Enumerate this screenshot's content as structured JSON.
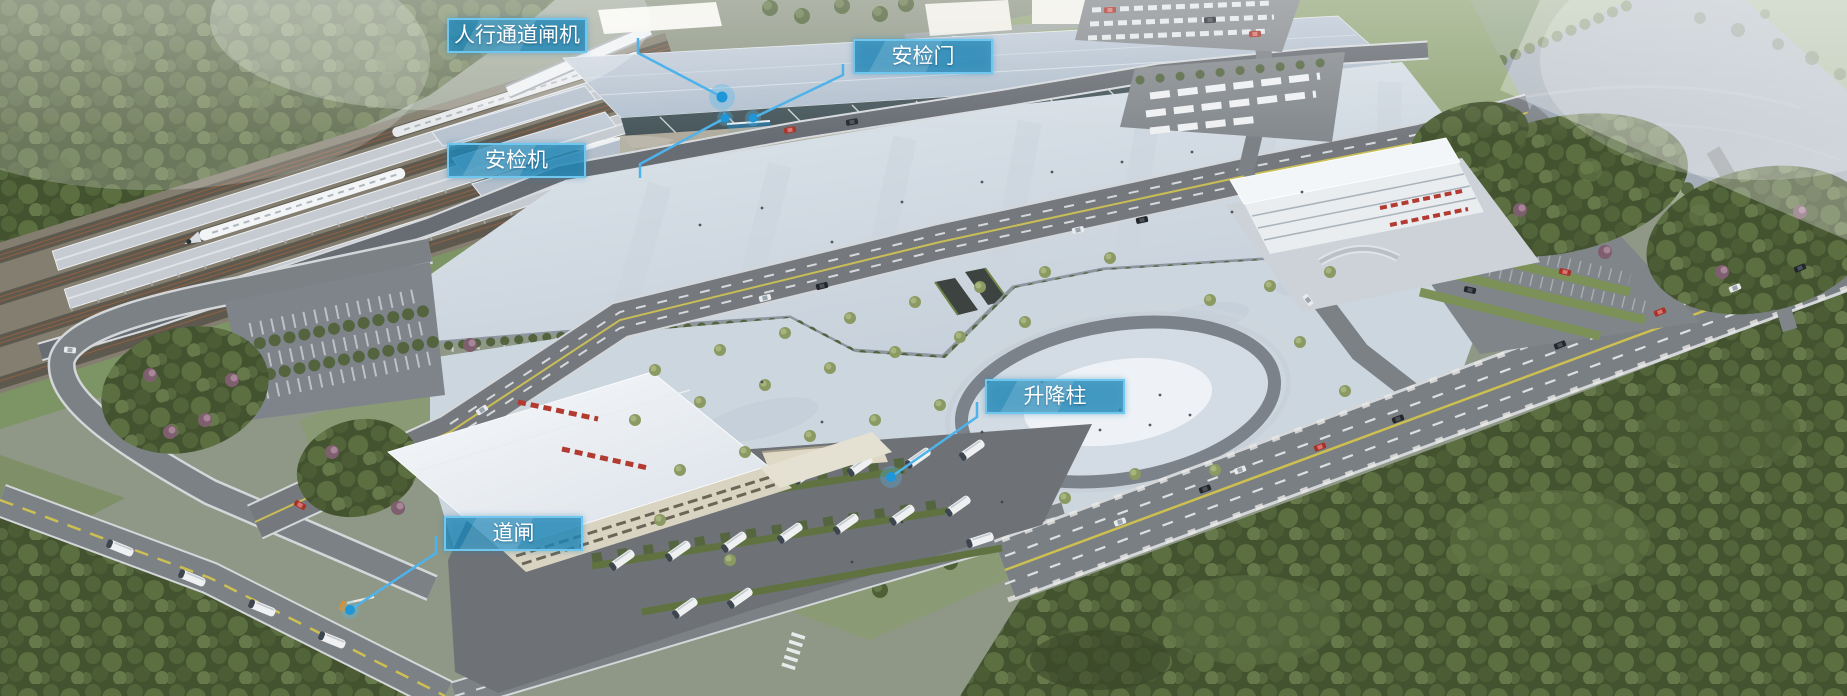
{
  "callouts": [
    {
      "id": "pedestrian-channel-gate",
      "label": "人行通道闸机"
    },
    {
      "id": "security-door",
      "label": "安检门"
    },
    {
      "id": "security-scanner",
      "label": "安检机"
    },
    {
      "id": "lifting-bollard",
      "label": "升降柱"
    },
    {
      "id": "barrier-gate",
      "label": "道闸"
    }
  ],
  "colors": {
    "callout_background": "#1b84b5",
    "callout_border": "#6fc6ef",
    "callout_text": "#ffffff",
    "leader_line": "#4db3ea",
    "marker_dot": "#1e96d8",
    "marker_halo": "#57b8ea"
  }
}
